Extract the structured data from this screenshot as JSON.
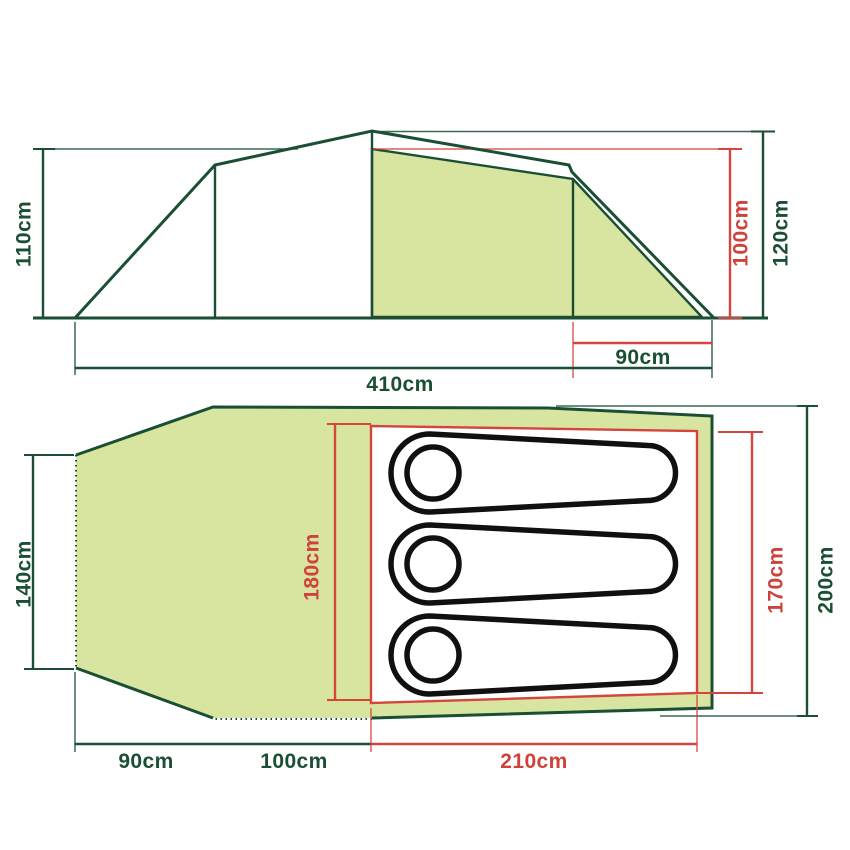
{
  "diagram_title": "tent-dimensions-diagram",
  "side_view": {
    "left_height_label": "110cm",
    "outer_height_label": "120cm",
    "inner_height_label": "100cm",
    "porch_depth_label": "90cm",
    "total_length_label": "410cm"
  },
  "floor_plan": {
    "rear_width_label": "140cm",
    "inner_width_label": "180cm",
    "door_side_width_label": "170cm",
    "outer_width_label": "200cm",
    "rear_depth_label": "90cm",
    "living_depth_label": "100cm",
    "bedroom_depth_label": "210cm",
    "sleeping_bag_count": 3
  },
  "colors": {
    "outline_green": "#1a4f33",
    "dimension_red": "#d5453d",
    "fill_green": "#d8e5a1",
    "sleeping_bag_black": "#101010",
    "background": "#ffffff"
  }
}
